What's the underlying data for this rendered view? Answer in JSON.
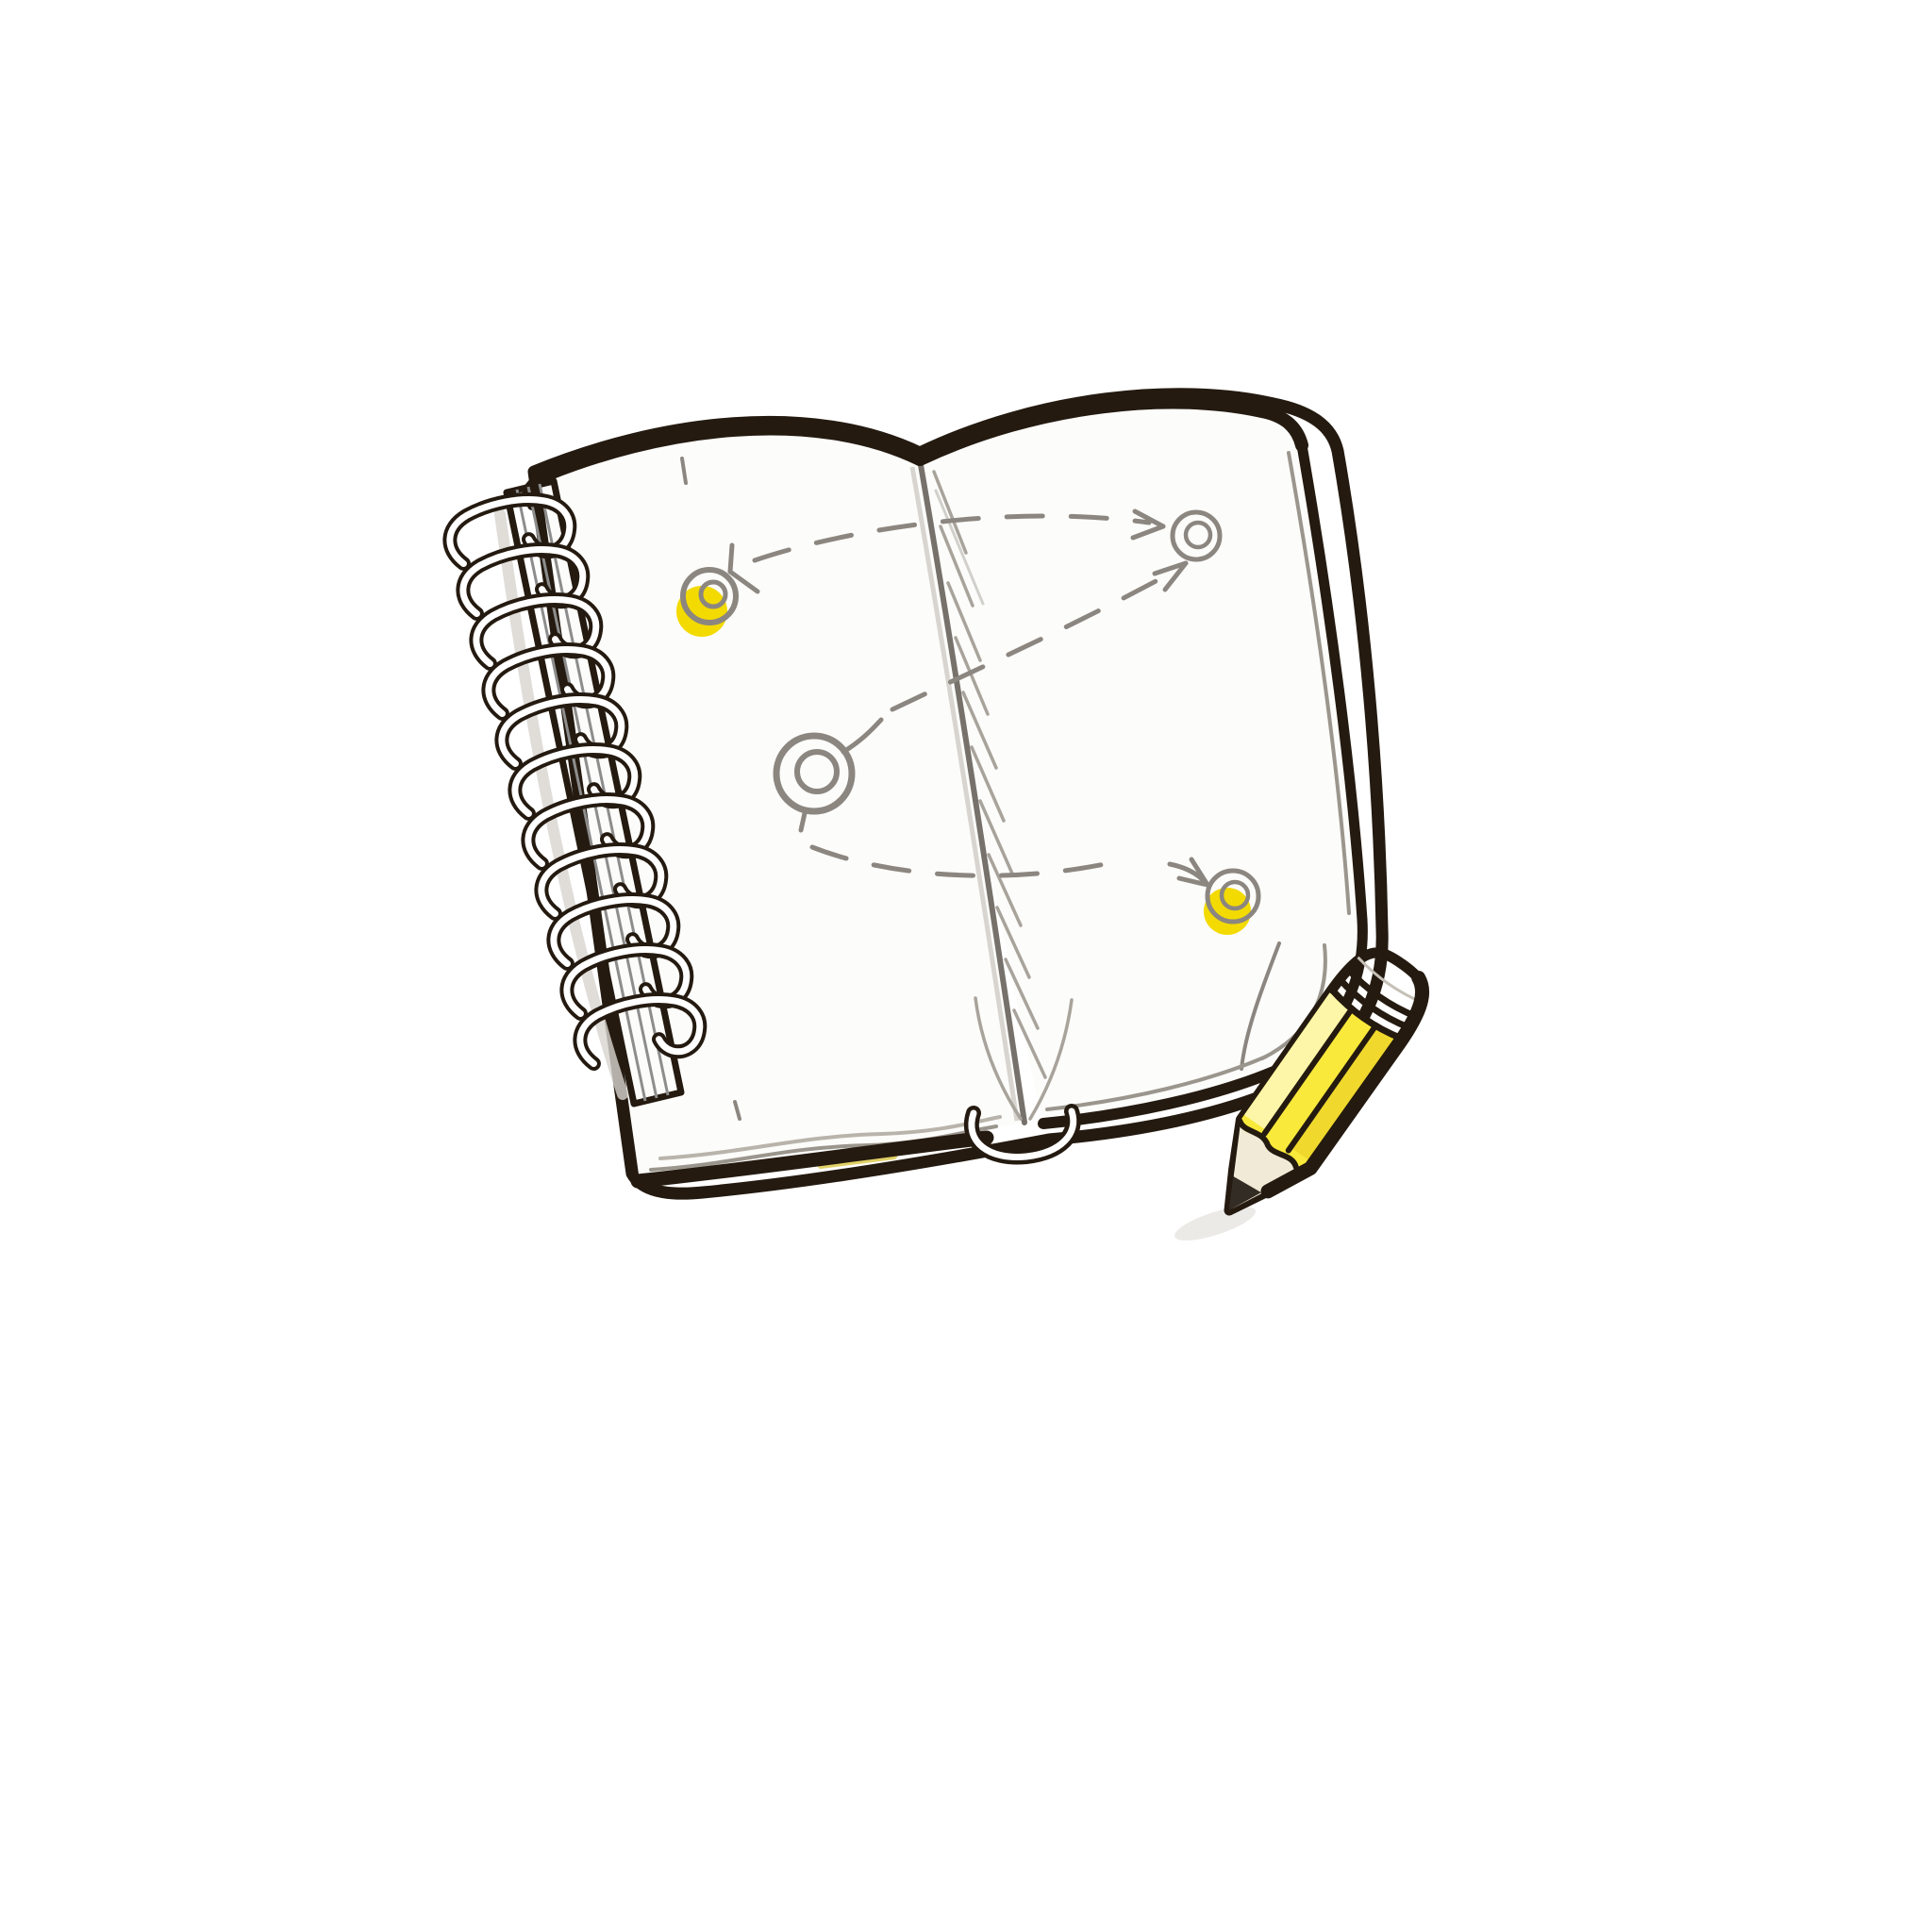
{
  "scene": {
    "description": "Hand-drawn cartoon illustration of an open spiral-bound notebook lying at a slight angle on a white background. The blank pages hold a sketched route plan: three double-ring circular waypoints joined by curved dashed arrows, two waypoints underlined with yellow highlighter. A short yellow pencil rests across the notebook's lower-right corner, tip pointing down-left.",
    "background_color": "#ffffff",
    "objects": {
      "notebook": {
        "type": "open spiral-bound sketchbook",
        "page_state": "blank white pages",
        "spiral_ring_count": 11,
        "spiral_side": "left",
        "cover_outline_color": "#241a10"
      },
      "route_sketch": {
        "waypoint_count": 3,
        "highlighted_waypoint_count": 2,
        "connector_style": "dashed curved arrows",
        "line_color": "#8c8680",
        "highlight_color": "#f3da00"
      },
      "pencil": {
        "body_color": "yellow",
        "position": "lower right corner, overlapping the page edge",
        "orientation": "tip pointing down-left",
        "parts": [
          "graphite tip",
          "wood cone",
          "faceted yellow body",
          "banded white ferrule"
        ]
      }
    }
  },
  "colors": {
    "outline": "#241a10",
    "page_white": "#fcfcfa",
    "sketch_gray": "#8c8680",
    "hatch_gray": "#a8a39b",
    "stack_gray": "#9b968d",
    "highlight_yellow": "#f3da00",
    "pencil_yellow": "#f9e93a",
    "pencil_yellow_light": "#fdf6a8",
    "pencil_yellow_dark": "#f0d92c",
    "pencil_wood": "#f1ead6",
    "graphite": "#332c24",
    "ferrule_white": "#f7f4ed",
    "ring_white": "#ffffff",
    "shadow_gray": "#d8d5d0",
    "sliver_yellow": "#dcc94e"
  }
}
